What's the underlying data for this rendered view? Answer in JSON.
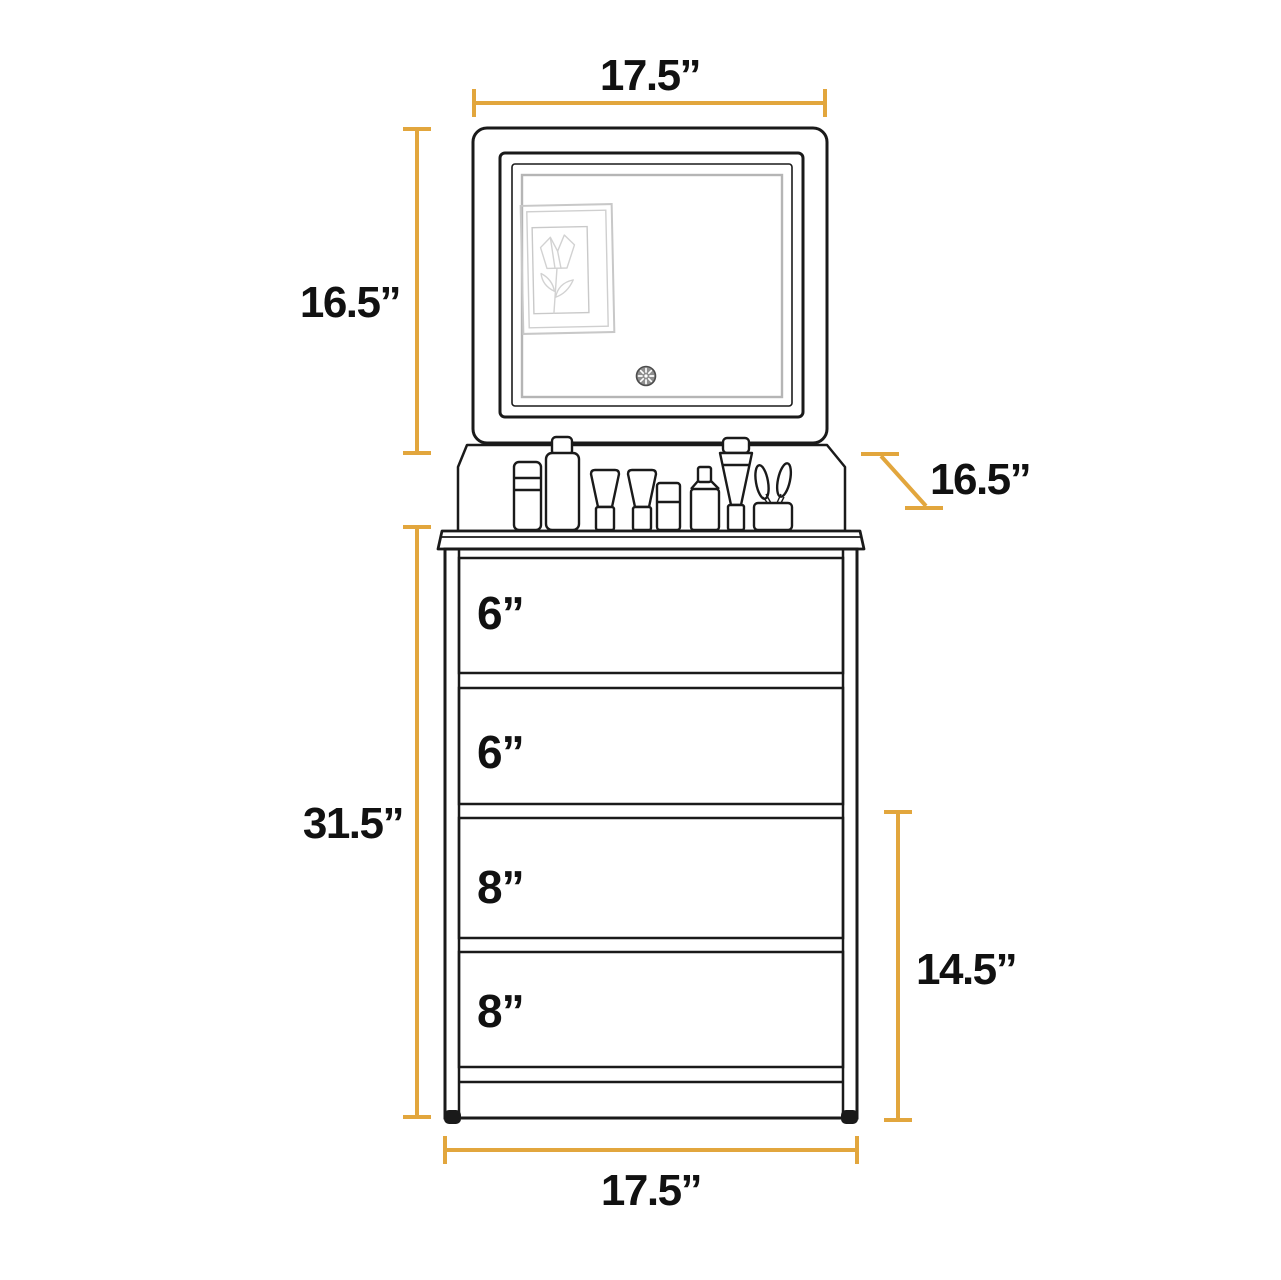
{
  "colors": {
    "accent": "#E2A63D",
    "line": "#1A1A1A",
    "glass": "#B5B5B5",
    "sketch": "#D2D2D2"
  },
  "diagram": {
    "subject": "vanity dresser with LED mirror and four drawers",
    "dims": {
      "mirror_width": "17.5”",
      "mirror_height": "16.5”",
      "depth": "16.5”",
      "total_height": "31.5”",
      "lower_height": "14.5”",
      "base_width": "17.5”"
    },
    "drawers": [
      {
        "label": "6”"
      },
      {
        "label": "6”"
      },
      {
        "label": "8”"
      },
      {
        "label": "8”"
      }
    ]
  }
}
